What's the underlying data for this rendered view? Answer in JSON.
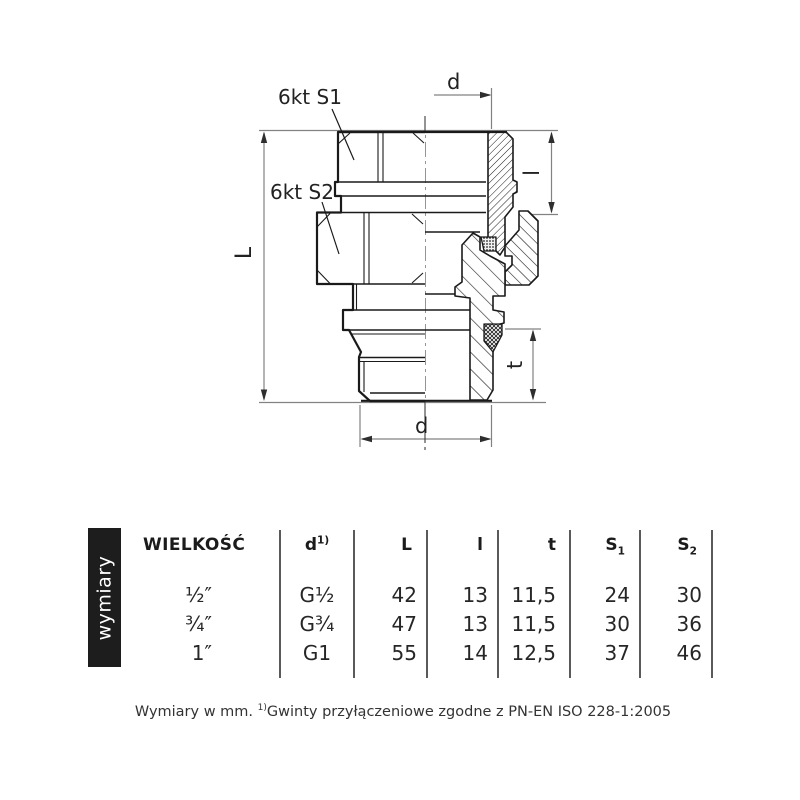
{
  "drawing": {
    "hex1_label": "6kt S1",
    "hex2_label": "6kt S2",
    "dim_d_top": "d",
    "dim_d_bottom": "d",
    "dim_L": "L",
    "dim_l": "l",
    "dim_t": "t"
  },
  "table": {
    "side_label": "wymiary",
    "headers": {
      "size": "WIELKOŚĆ",
      "d_base": "d",
      "d_sup": "1)",
      "L": "L",
      "l": "l",
      "t": "t",
      "s1_base": "S",
      "s1_sub": "1",
      "s2_base": "S",
      "s2_sub": "2"
    },
    "rows": [
      [
        "½″",
        "G½",
        "42",
        "13",
        "11,5",
        "24",
        "30"
      ],
      [
        "¾″",
        "G¾",
        "47",
        "13",
        "11,5",
        "30",
        "36"
      ],
      [
        "1″",
        "G1",
        "55",
        "14",
        "12,5",
        "37",
        "46"
      ]
    ]
  },
  "footer": {
    "prefix": "Wymiary w mm. ",
    "sup": "1)",
    "text": "Gwinty przyłączeniowe zgodne z PN-EN ISO 228-1:2005"
  },
  "colors": {
    "ink": "#1a1a1a",
    "dim_line": "#828282",
    "sidebar_bg": "#1d1d1d",
    "sidebar_text": "#ffffff"
  }
}
